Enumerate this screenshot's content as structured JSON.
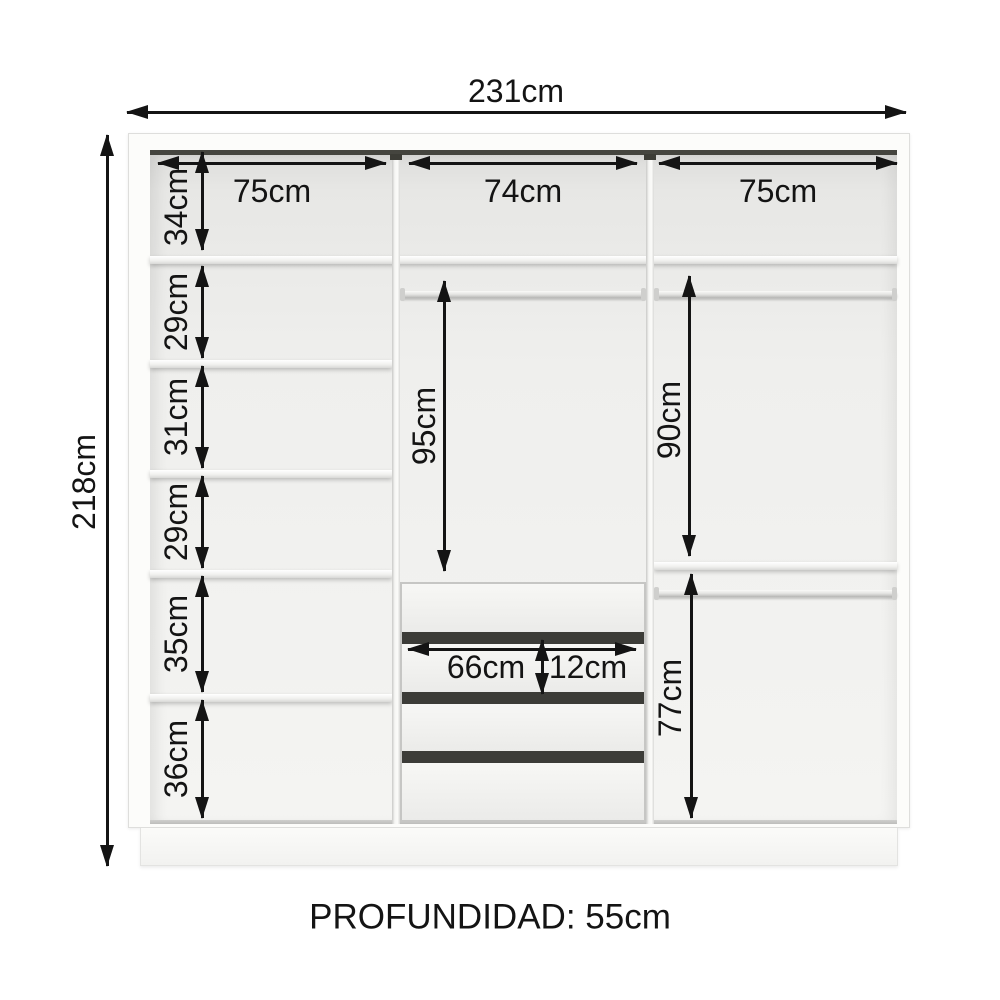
{
  "diagram": {
    "overall_width": "231cm",
    "overall_height": "218cm",
    "section_widths": {
      "left": "75cm",
      "middle": "74cm",
      "right": "75cm"
    },
    "left_column_heights": [
      "34cm",
      "29cm",
      "31cm",
      "29cm",
      "35cm",
      "36cm"
    ],
    "middle_section": {
      "hanging_height": "95cm",
      "drawer_width": "66cm",
      "drawer_front_height": "12cm",
      "drawer_count": 4
    },
    "right_section": {
      "upper_hanging_height": "90cm",
      "lower_hanging_height": "77cm"
    },
    "depth_label": "PROFUNDIDAD: 55cm"
  },
  "colors": {
    "arrow": "#141414",
    "background": "#ffffff",
    "carcass": "#fcfcfa",
    "interior_gray": "#e9e9e7",
    "drawer_gap": "#3c3c38"
  }
}
